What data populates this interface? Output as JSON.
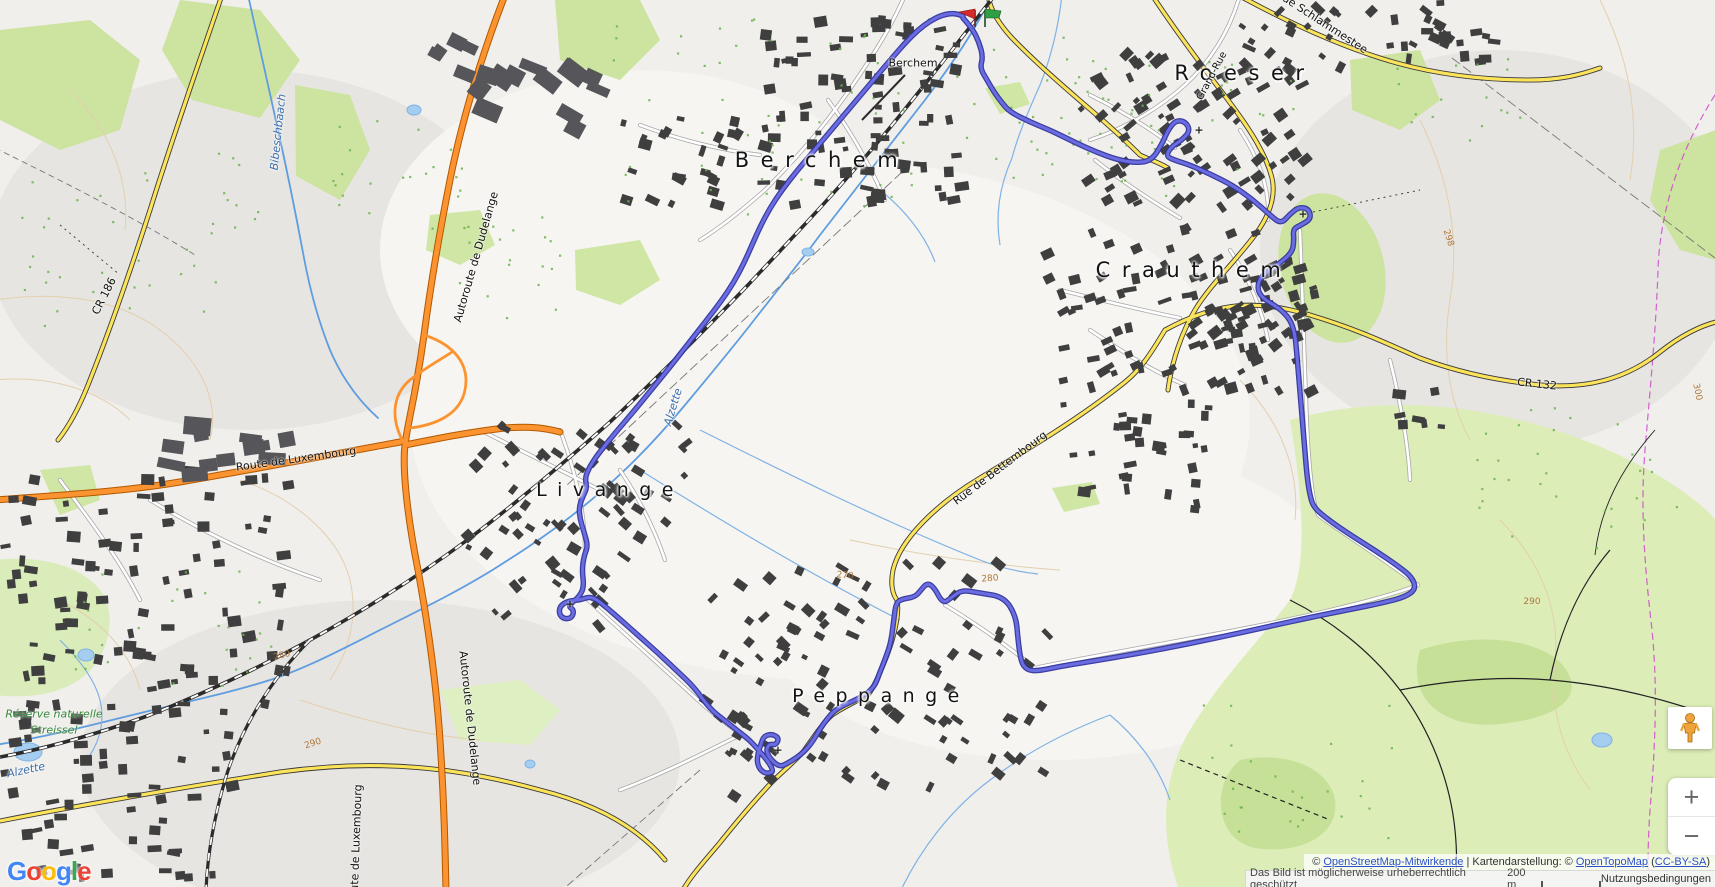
{
  "map": {
    "towns": {
      "berchem": "Berchem",
      "roeser": "Roeser",
      "crauthem": "Crauthem",
      "livange": "Livange",
      "peppange": "Peppange"
    },
    "station": "Berchem",
    "reserve_line1": "Réserve naturelle",
    "reserve_line2": "Streissel",
    "roads": {
      "cr186": "CR 186",
      "cr132": "CR 132",
      "autoroute1": "Autoroute de Dudelange",
      "autoroute2": "Autoroute de Dudelange",
      "route_lux": "Route de Luxembourg",
      "route_lux2": "Route de Luxembourg",
      "bettembourg": "Rue de Bettembourg",
      "grand_rue": "Grand-Rue",
      "schlammestee": "Rue Schlammestee"
    },
    "waters": {
      "bibeschbaach": "Bibeschbaach",
      "alzette1": "Alzette",
      "alzette2": "Alzette"
    },
    "contours": [
      "280",
      "290",
      "270",
      "280",
      "298",
      "300",
      "290"
    ],
    "church_glyph": "+"
  },
  "route": {
    "color_outer": "#32349b",
    "color_inner": "#6a6ce2",
    "points": [
      [
        963,
        18
      ],
      [
        972,
        28
      ],
      [
        979,
        42
      ],
      [
        983,
        57
      ],
      [
        980,
        68
      ],
      [
        987,
        80
      ],
      [
        994,
        92
      ],
      [
        1002,
        103
      ],
      [
        1010,
        112
      ],
      [
        1030,
        122
      ],
      [
        1052,
        131
      ],
      [
        1074,
        142
      ],
      [
        1096,
        152
      ],
      [
        1118,
        160
      ],
      [
        1138,
        163
      ],
      [
        1152,
        160
      ],
      [
        1162,
        144
      ],
      [
        1168,
        130
      ],
      [
        1176,
        120
      ],
      [
        1186,
        122
      ],
      [
        1190,
        131
      ],
      [
        1182,
        140
      ],
      [
        1171,
        147
      ],
      [
        1166,
        156
      ],
      [
        1174,
        160
      ],
      [
        1190,
        165
      ],
      [
        1210,
        174
      ],
      [
        1232,
        185
      ],
      [
        1252,
        199
      ],
      [
        1270,
        215
      ],
      [
        1281,
        224
      ],
      [
        1290,
        214
      ],
      [
        1299,
        207
      ],
      [
        1309,
        209
      ],
      [
        1311,
        219
      ],
      [
        1301,
        225
      ],
      [
        1293,
        229
      ],
      [
        1294,
        241
      ],
      [
        1292,
        253
      ],
      [
        1276,
        266
      ],
      [
        1261,
        276
      ],
      [
        1257,
        288
      ],
      [
        1262,
        298
      ],
      [
        1279,
        308
      ],
      [
        1290,
        319
      ],
      [
        1295,
        334
      ],
      [
        1297,
        356
      ],
      [
        1299,
        380
      ],
      [
        1301,
        404
      ],
      [
        1303,
        428
      ],
      [
        1305,
        452
      ],
      [
        1307,
        476
      ],
      [
        1310,
        496
      ],
      [
        1314,
        508
      ],
      [
        1330,
        521
      ],
      [
        1352,
        536
      ],
      [
        1376,
        551
      ],
      [
        1398,
        566
      ],
      [
        1412,
        577
      ],
      [
        1416,
        589
      ],
      [
        1405,
        597
      ],
      [
        1382,
        603
      ],
      [
        1352,
        609
      ],
      [
        1312,
        617
      ],
      [
        1262,
        628
      ],
      [
        1212,
        639
      ],
      [
        1162,
        649
      ],
      [
        1112,
        658
      ],
      [
        1062,
        666
      ],
      [
        1038,
        671
      ],
      [
        1027,
        670
      ],
      [
        1021,
        662
      ],
      [
        1018,
        640
      ],
      [
        1016,
        616
      ],
      [
        1004,
        597
      ],
      [
        980,
        593
      ],
      [
        962,
        590
      ],
      [
        952,
        597
      ],
      [
        943,
        604
      ],
      [
        934,
        587
      ],
      [
        927,
        583
      ],
      [
        921,
        590
      ],
      [
        915,
        597
      ],
      [
        902,
        599
      ],
      [
        896,
        603
      ],
      [
        894,
        618
      ],
      [
        891,
        642
      ],
      [
        886,
        657
      ],
      [
        880,
        672
      ],
      [
        874,
        688
      ],
      [
        860,
        698
      ],
      [
        844,
        705
      ],
      [
        834,
        711
      ],
      [
        827,
        719
      ],
      [
        820,
        729
      ],
      [
        813,
        741
      ],
      [
        805,
        751
      ],
      [
        796,
        758
      ],
      [
        788,
        763
      ],
      [
        780,
        767
      ],
      [
        771,
        760
      ],
      [
        766,
        751
      ],
      [
        769,
        744
      ],
      [
        776,
        745
      ],
      [
        779,
        738
      ],
      [
        772,
        734
      ],
      [
        764,
        736
      ],
      [
        761,
        744
      ],
      [
        758,
        753
      ],
      [
        757,
        763
      ],
      [
        761,
        771
      ],
      [
        768,
        774
      ],
      [
        775,
        770
      ],
      [
        752,
        742
      ],
      [
        738,
        731
      ],
      [
        724,
        720
      ],
      [
        710,
        709
      ],
      [
        694,
        687
      ],
      [
        676,
        670
      ],
      [
        658,
        653
      ],
      [
        640,
        637
      ],
      [
        622,
        621
      ],
      [
        606,
        607
      ],
      [
        592,
        596
      ],
      [
        580,
        600
      ],
      [
        568,
        601
      ],
      [
        560,
        606
      ],
      [
        559,
        614
      ],
      [
        564,
        619
      ],
      [
        572,
        618
      ],
      [
        574,
        610
      ],
      [
        568,
        606
      ],
      [
        580,
        596
      ],
      [
        584,
        586
      ],
      [
        582,
        570
      ],
      [
        584,
        556
      ],
      [
        588,
        546
      ],
      [
        584,
        532
      ],
      [
        580,
        519
      ],
      [
        579,
        507
      ],
      [
        583,
        496
      ],
      [
        587,
        488
      ],
      [
        585,
        478
      ],
      [
        589,
        468
      ],
      [
        596,
        457
      ],
      [
        603,
        448
      ],
      [
        616,
        432
      ],
      [
        634,
        411
      ],
      [
        652,
        389
      ],
      [
        670,
        367
      ],
      [
        688,
        344
      ],
      [
        706,
        321
      ],
      [
        722,
        300
      ],
      [
        734,
        282
      ],
      [
        744,
        263
      ],
      [
        752,
        245
      ],
      [
        760,
        227
      ],
      [
        770,
        208
      ],
      [
        782,
        190
      ],
      [
        796,
        172
      ],
      [
        812,
        153
      ],
      [
        828,
        134
      ],
      [
        844,
        115
      ],
      [
        860,
        96
      ],
      [
        876,
        77
      ],
      [
        892,
        58
      ],
      [
        906,
        42
      ],
      [
        918,
        30
      ],
      [
        930,
        21
      ],
      [
        942,
        15
      ],
      [
        954,
        13
      ],
      [
        963,
        16
      ]
    ]
  },
  "markers": {
    "start_color": "#d62b2b",
    "finish_color": "#2f9e44"
  },
  "controls": {
    "zoom_in_label": "+",
    "zoom_out_label": "−"
  },
  "logo": {
    "letters": [
      {
        "ch": "G",
        "color": "#4285F4"
      },
      {
        "ch": "o",
        "color": "#EA4335"
      },
      {
        "ch": "o",
        "color": "#FBBC05"
      },
      {
        "ch": "g",
        "color": "#4285F4"
      },
      {
        "ch": "l",
        "color": "#34A853"
      },
      {
        "ch": "e",
        "color": "#EA4335"
      }
    ]
  },
  "attribution": {
    "copyright_symbol": "©",
    "osm_link": "OpenStreetMap-Mitwirkende",
    "middle": "| Kartendarstellung: ©",
    "otm_link": "OpenTopoMap",
    "license_open": "(",
    "license_link": "CC-BY-SA",
    "license_close": ")",
    "protected_notice": "Das Bild ist möglicherweise urheberrechtlich geschützt",
    "scale_label": "200 m",
    "terms_link": "Nutzungsbedingungen"
  }
}
